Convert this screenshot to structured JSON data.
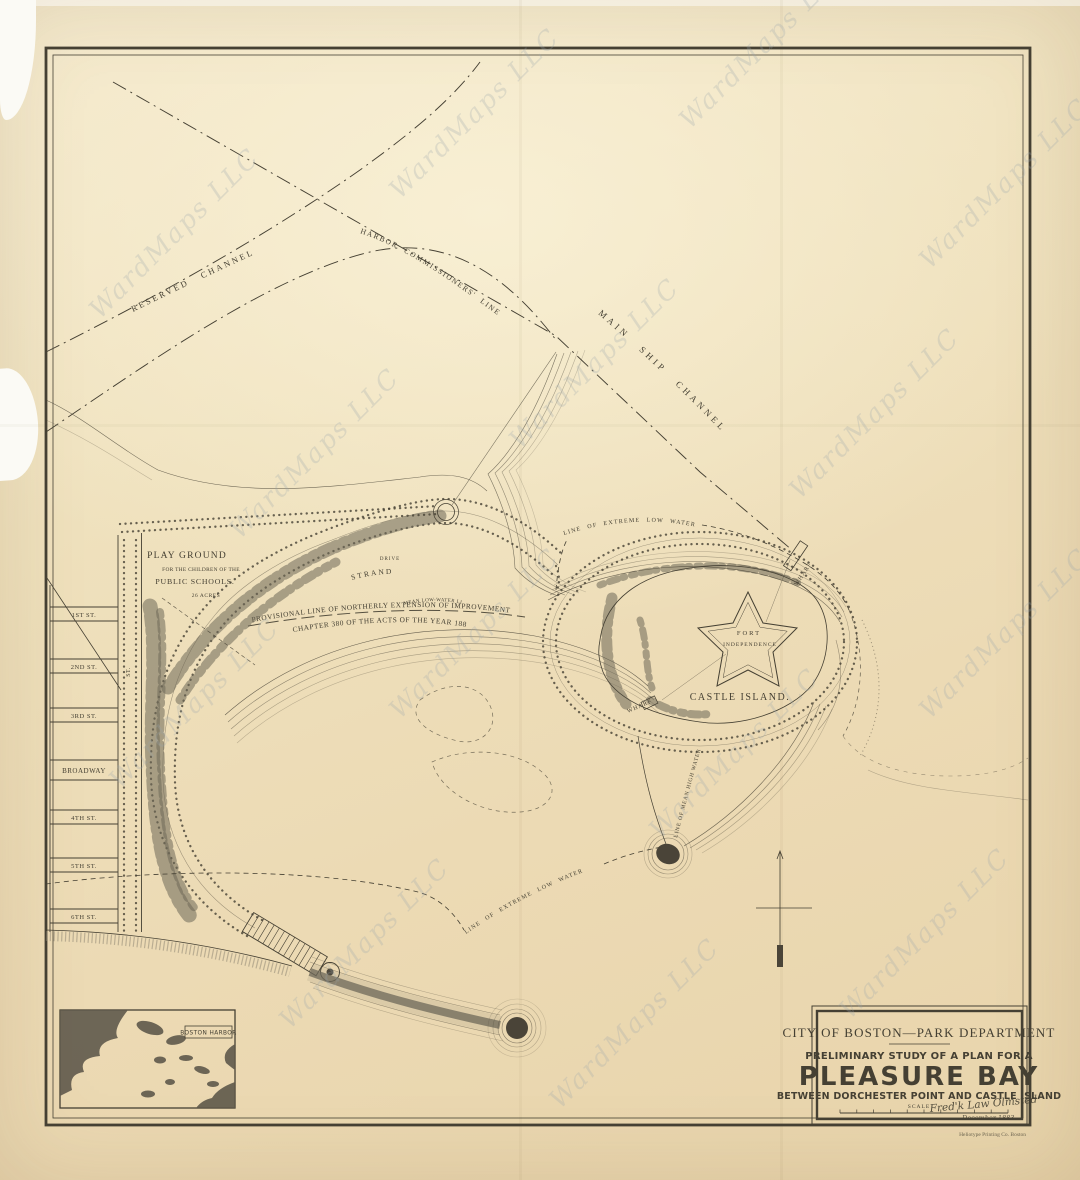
{
  "sheet": {
    "watermark": "WardMaps LLC"
  },
  "channels": {
    "reserved": "RESERVED CHANNEL",
    "harbor_commissioners": "HARBOR COMMISSIONERS' LINE",
    "main_ship": "MAIN SHIP CHANNEL"
  },
  "playground": {
    "title": "PLAY GROUND",
    "line2": "FOR THE CHILDREN OF THE",
    "line3": "PUBLIC SCHOOLS.",
    "acres": "26 ACRES"
  },
  "streets": {
    "labels": [
      "1ST ST.",
      "2ND ST.",
      "3RD ST.",
      "BROADWAY",
      "4TH ST.",
      "5TH ST.",
      "6TH ST."
    ],
    "vertical": "ST."
  },
  "bay": {
    "strand": "STRAND",
    "drive": "DRIVE",
    "mean_low_water": "MEAN LOW-WATER LINE",
    "provisional_1": "PROVISIONAL LINE OF NORTHERLY EXTENSION OF IMPROVEMENT DEFINED BY",
    "provisional_2": "CHAPTER 380 OF THE ACTS OF THE YEAR 1883.",
    "extreme_low_water_north": "LINE OF EXTREME LOW WATER",
    "extreme_low_water_south": "LINE OF EXTREME LOW WATER",
    "mean_high_water": "LINE OF MEAN HIGH WATER"
  },
  "island": {
    "fort_line1": "FORT",
    "fort_line2": "INDEPENDENCE",
    "name": "CASTLE ISLAND.",
    "wharf_ne": "WHARF",
    "wharf_w": "WHARF"
  },
  "inset": {
    "label": "BOSTON HARBOR"
  },
  "title_block": {
    "department": "CITY OF BOSTON—PARK DEPARTMENT",
    "subtitle": "PRELIMINARY STUDY OF A PLAN FOR A",
    "title": "PLEASURE BAY",
    "between": "BETWEEN DORCHESTER POINT AND CASTLE ISLAND",
    "scale_label": "SCALE",
    "signature": "Fred'k Law Olmsted",
    "date": "December 1883.",
    "imprint": "Heliotype Printing Co. Boston"
  },
  "colors": {
    "paper": "#eedcb8",
    "ink": "#454033",
    "ink_light": "#6b6557",
    "foliage": "#6e6758",
    "dark": "#4a4438",
    "watermark": "#9aa6ad"
  }
}
